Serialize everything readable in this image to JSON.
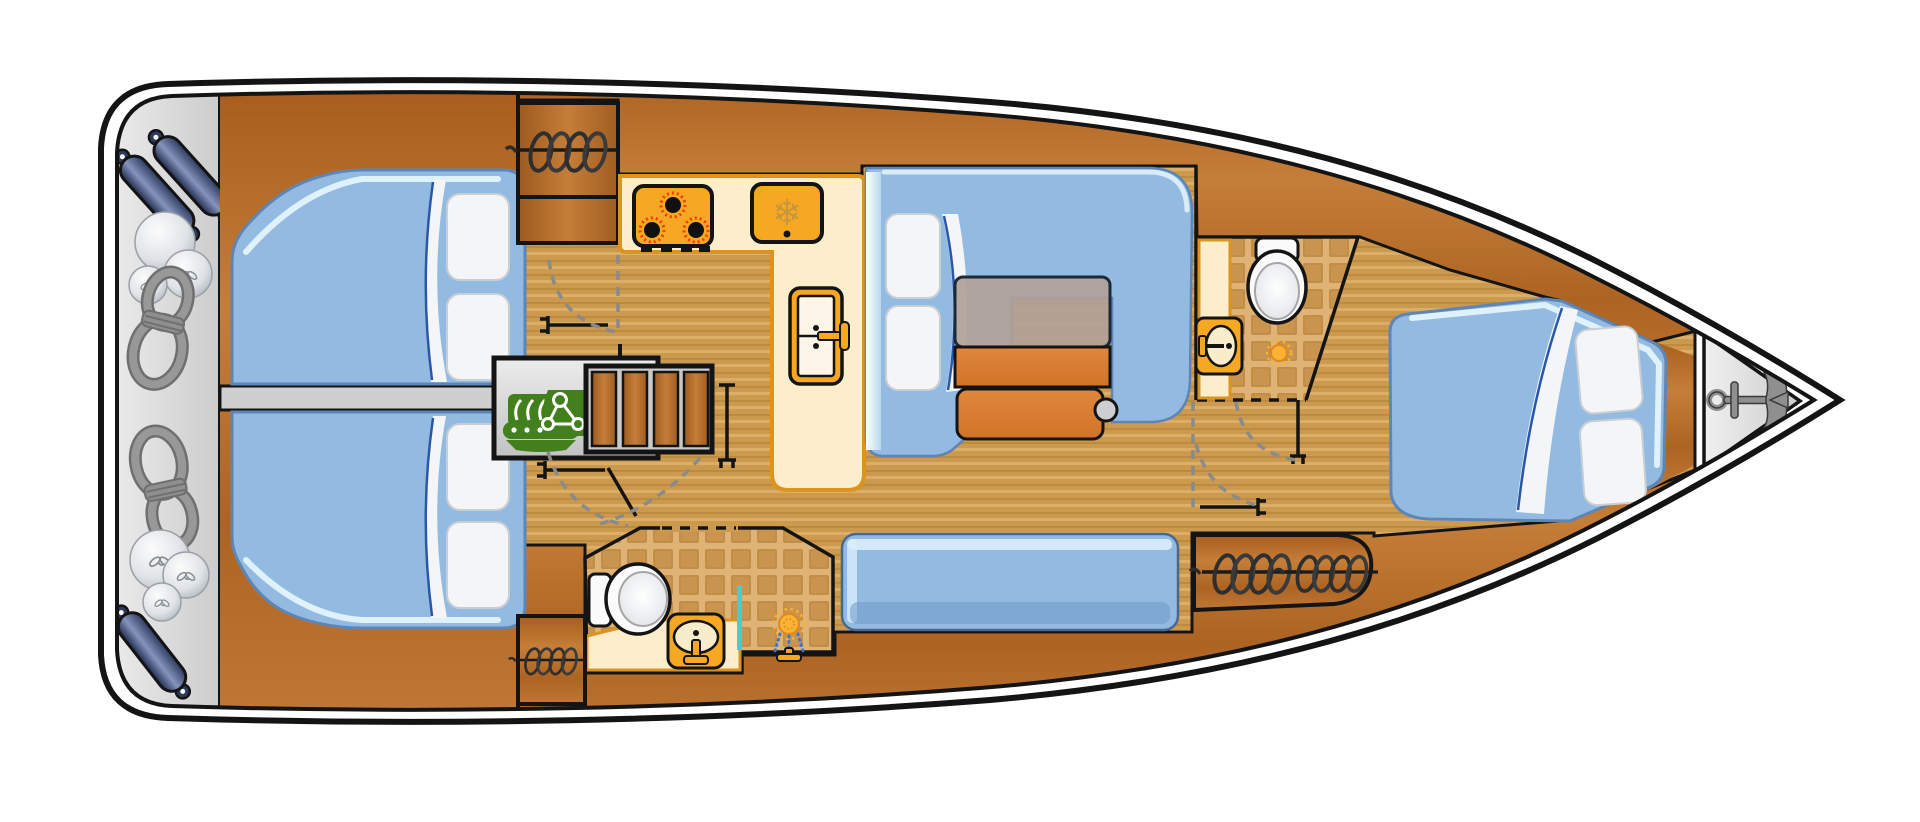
{
  "title": "sailing-yacht-interior-floor-plan-top-view",
  "palette": {
    "hull_white": "#ffffff",
    "outline": "#141414",
    "deck_gray_light": "#ececec",
    "deck_gray": "#d9d9d9",
    "divider_gray": "#cfcfcf",
    "wood_dark": "#a85d1e",
    "wood_mid": "#c57e38",
    "floor_tan": "#cb9a4e",
    "floor_stripe": "#dcae67",
    "tile_base": "#dfb276",
    "tile_square": "#c28d46",
    "counter_cream": "#fdeecb",
    "counter_border": "#dd941f",
    "appliance_orange": "#f7a823",
    "basin_cream": "#f8ecca",
    "bed_blue": "#93bbe2",
    "bed_edge": "#5d86b6",
    "bed_highlight": "#dff2fc",
    "pillow_white": "#f3f5f7",
    "pillow_edge": "#c9ced4",
    "fold_navy": "#2b57a8",
    "table_gray": "#b0a198",
    "table_wood": "#dd8338",
    "bench_knob_gray": "#cdced0",
    "engine_green": "#427f1d",
    "engine_box_gray": "#dcdcdc",
    "ladder_gray": "#c9c9c9",
    "fender_navy": "#2c3a5e",
    "fender_light": "#8694bd",
    "rope_gray": "#8f8f8f",
    "rope_dark": "#6f6f6f",
    "ball_gray": "#dfe3e7",
    "teal_divider": "#49cbd4",
    "water_blue": "#3a76d2",
    "burner_red": "#f43a00",
    "burner_black": "#111111",
    "snowflake_tan": "#c8963c",
    "sun_orange": "#f9b234",
    "sun_ring": "#e2891a",
    "anchor_gray": "#8f8f8f",
    "toilet_white": "#fafafa"
  },
  "symbols": {
    "snowflake_glyph": "❄"
  },
  "icons": [
    "stove-icon",
    "fridge-icon",
    "snowflake-icon",
    "galley-sink-icon",
    "engine-icon",
    "companionway-ladder-icon",
    "toilet-icon",
    "bathroom-sink-icon",
    "shower-head-icon",
    "drain-icon",
    "spring-coil-icon",
    "anchor-icon",
    "fender-icon",
    "ball-fender-icon",
    "rope-coil-icon",
    "door-leaf-symbol",
    "door-swing-arc"
  ],
  "areas": [
    "stern-gear-locker",
    "aft-cabin-port",
    "aft-cabin-starboard",
    "engine-compartment",
    "companionway",
    "galley",
    "salon-settee",
    "salon-table",
    "mid-bathroom",
    "aft-bathroom",
    "salon-bench-sofa",
    "stowage-locker",
    "corridor",
    "forward-cabin",
    "bow-anchor-locker"
  ]
}
